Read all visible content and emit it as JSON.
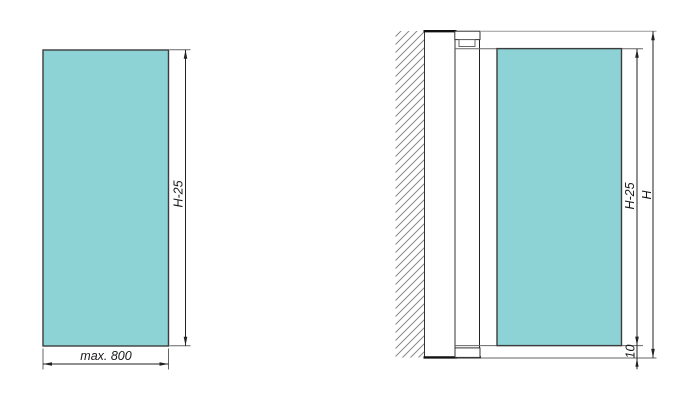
{
  "figure": {
    "title": "glass-panel-technical-drawing",
    "left_view": {
      "description": "glass pane front view",
      "height_label": "H-25",
      "width_label": "max. 800"
    },
    "right_view": {
      "description": "installed assembly with wall profile and pivot",
      "glass_height_label": "H-25",
      "total_height_label": "H",
      "bottom_gap_label": "10"
    },
    "colors": {
      "glass": "#8dd2d5",
      "dimension_line": "#222222",
      "extension_line": "#666666",
      "hatch": "#8a8a8a"
    }
  }
}
